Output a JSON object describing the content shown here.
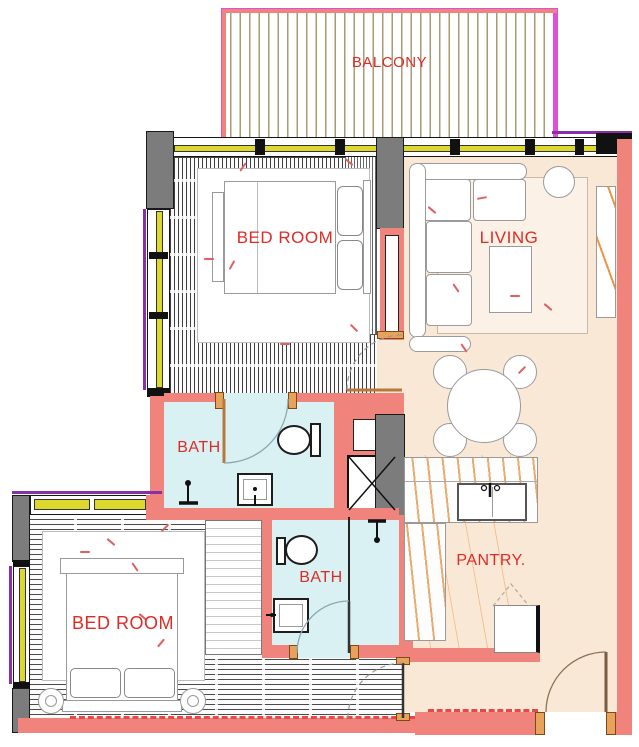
{
  "document": {
    "type": "apartment-floor-plan"
  },
  "rooms": {
    "balcony": "BALCONY",
    "bedroom_top": "BED ROOM",
    "living": "LIVING",
    "bath_top": "BATH",
    "bath_bottom": "BATH",
    "bedroom_bottom": "BED ROOM",
    "pantry": "PANTRY."
  },
  "colors": {
    "wall_pink": "#F0837C",
    "floor_peach": "#FAE8D7",
    "bath_cyan": "#D9F1F3",
    "label_red": "#DF2B26",
    "column_gray": "#7C7C7C",
    "window_yellow": "#DDD82E",
    "window_purple": "#8B2FA8",
    "balcony_magenta": "#E04FD8",
    "dash_red": "#E84848"
  }
}
